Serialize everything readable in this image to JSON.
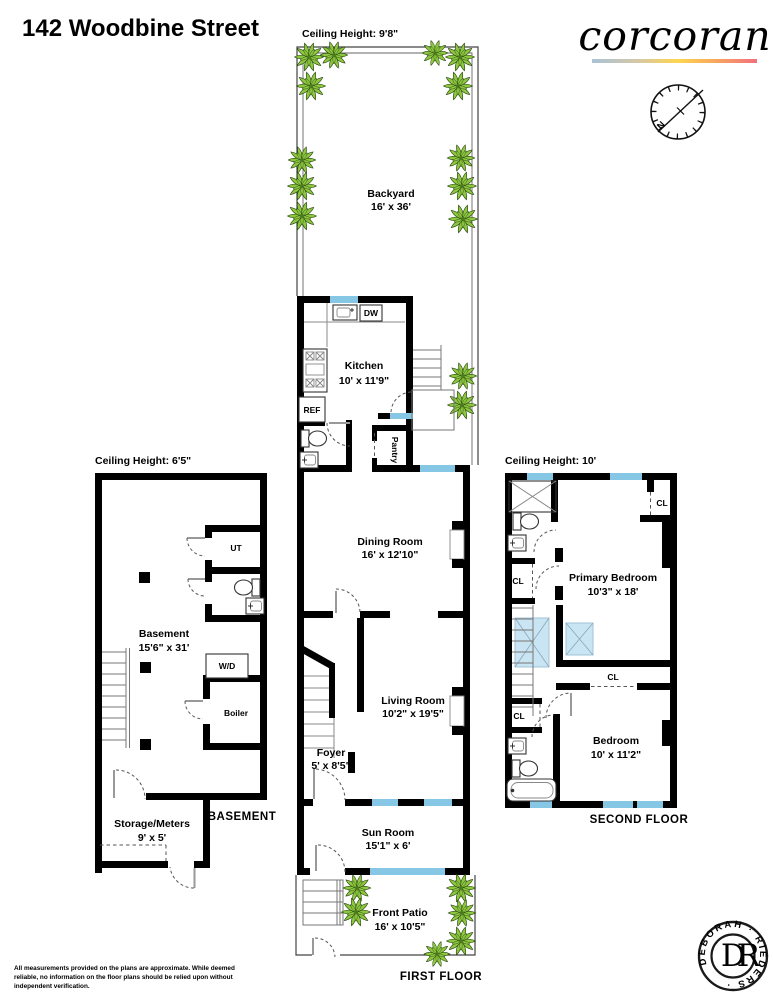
{
  "header": {
    "title": "142 Woodbine Street",
    "brand": "corcoran"
  },
  "compass": {
    "north_label": "N"
  },
  "colors": {
    "wall": "#000000",
    "window_blue": "#85c7e5",
    "skylight_blue": "#c9e4f2",
    "plant_green": "#8dc63f",
    "brand_gradient": [
      "#a9c2d4",
      "#d6c8a6",
      "#fdd64f",
      "#f9a85c",
      "#f1707e"
    ]
  },
  "first_floor": {
    "ceiling_label": "Ceiling Height: 9'8\"",
    "floor_label": "FIRST FLOOR",
    "rooms": {
      "backyard": {
        "name": "Backyard",
        "dims": "16' x 36'"
      },
      "kitchen": {
        "name": "Kitchen",
        "dims": "10' x 11'9\""
      },
      "pantry": {
        "name": "Pantry"
      },
      "dining_room": {
        "name": "Dining Room",
        "dims": "16' x 12'10\""
      },
      "living_room": {
        "name": "Living Room",
        "dims": "10'2\" x 19'5\""
      },
      "foyer": {
        "name": "Foyer",
        "dims": "5' x 8'5\""
      },
      "sun_room": {
        "name": "Sun Room",
        "dims": "15'1\" x 6'"
      },
      "front_patio": {
        "name": "Front Patio",
        "dims": "16' x 10'5\""
      }
    },
    "appliances": {
      "dishwasher": "DW",
      "refrigerator": "REF"
    }
  },
  "basement": {
    "ceiling_label": "Ceiling Height: 6'5\"",
    "floor_label": "BASEMENT",
    "rooms": {
      "basement": {
        "name": "Basement",
        "dims": "15'6\" x 31'"
      },
      "utility": {
        "name": "UT"
      },
      "boiler": {
        "name": "Boiler"
      },
      "storage": {
        "name": "Storage/Meters",
        "dims": "9' x 5'"
      }
    },
    "appliances": {
      "washer_dryer": "W/D"
    }
  },
  "second_floor": {
    "ceiling_label": "Ceiling Height: 10'",
    "floor_label": "SECOND FLOOR",
    "rooms": {
      "primary_bedroom": {
        "name": "Primary Bedroom",
        "dims": "10'3\" x 18'"
      },
      "bedroom": {
        "name": "Bedroom",
        "dims": "10' x 11'2\""
      },
      "closet": "CL"
    }
  },
  "footer": {
    "disclaimer_lines": [
      "All measurements provided on the plans are approximate. While deemed",
      "reliable, no information on the floor plans should be relied upon without",
      "independent verification."
    ]
  },
  "stamp": {
    "ring_text": "DEBORAH · RIEDERS ·",
    "monogram": "DR"
  }
}
